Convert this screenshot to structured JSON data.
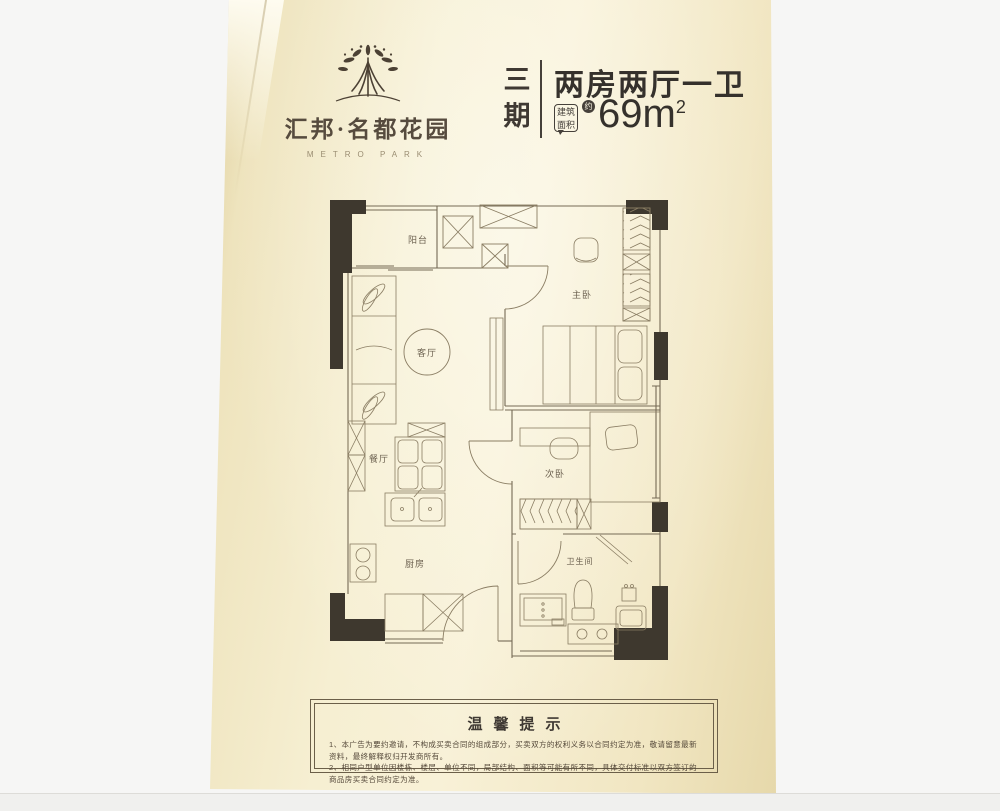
{
  "page": {
    "background_color": "#f6f6f5",
    "paper_edge_color": "#e6d8aa",
    "paper_center_color": "#f8f1d7",
    "wall_color": "#3e382e",
    "line_color": "#8a7d63",
    "text_color": "#3f3933"
  },
  "header": {
    "logo": {
      "icon": "tree-logo",
      "brand_cn": "汇邦·名都花园",
      "brand_en": "METRO PARK"
    },
    "phase_label": "三期",
    "unit_title": "两房两厅一卫",
    "area_label_line1": "建筑",
    "area_label_line2": "面积",
    "area_approx": "约",
    "area_value": "69m",
    "area_sup": "2"
  },
  "floorplan": {
    "rooms": [
      {
        "id": "balcony",
        "label": "阳台"
      },
      {
        "id": "living-room",
        "label": "客厅"
      },
      {
        "id": "master-bedroom",
        "label": "主卧"
      },
      {
        "id": "dining-room",
        "label": "餐厅"
      },
      {
        "id": "second-bedroom",
        "label": "次卧"
      },
      {
        "id": "kitchen",
        "label": "厨房"
      },
      {
        "id": "bathroom",
        "label": "卫生间"
      }
    ]
  },
  "tips": {
    "title": "温馨提示",
    "lines": [
      "1、本广告为要约邀请，不构成买卖合同的组成部分，买卖双方的权利义务以合同约定为准，敬请留意最新资料，最终解释权归开发商所有。",
      "2、相同户型单位因楼栋、楼层、单位不同，局部结构、面积等可能有所不同，具体交付标准以双方签订的商品房买卖合同约定为准。"
    ]
  }
}
